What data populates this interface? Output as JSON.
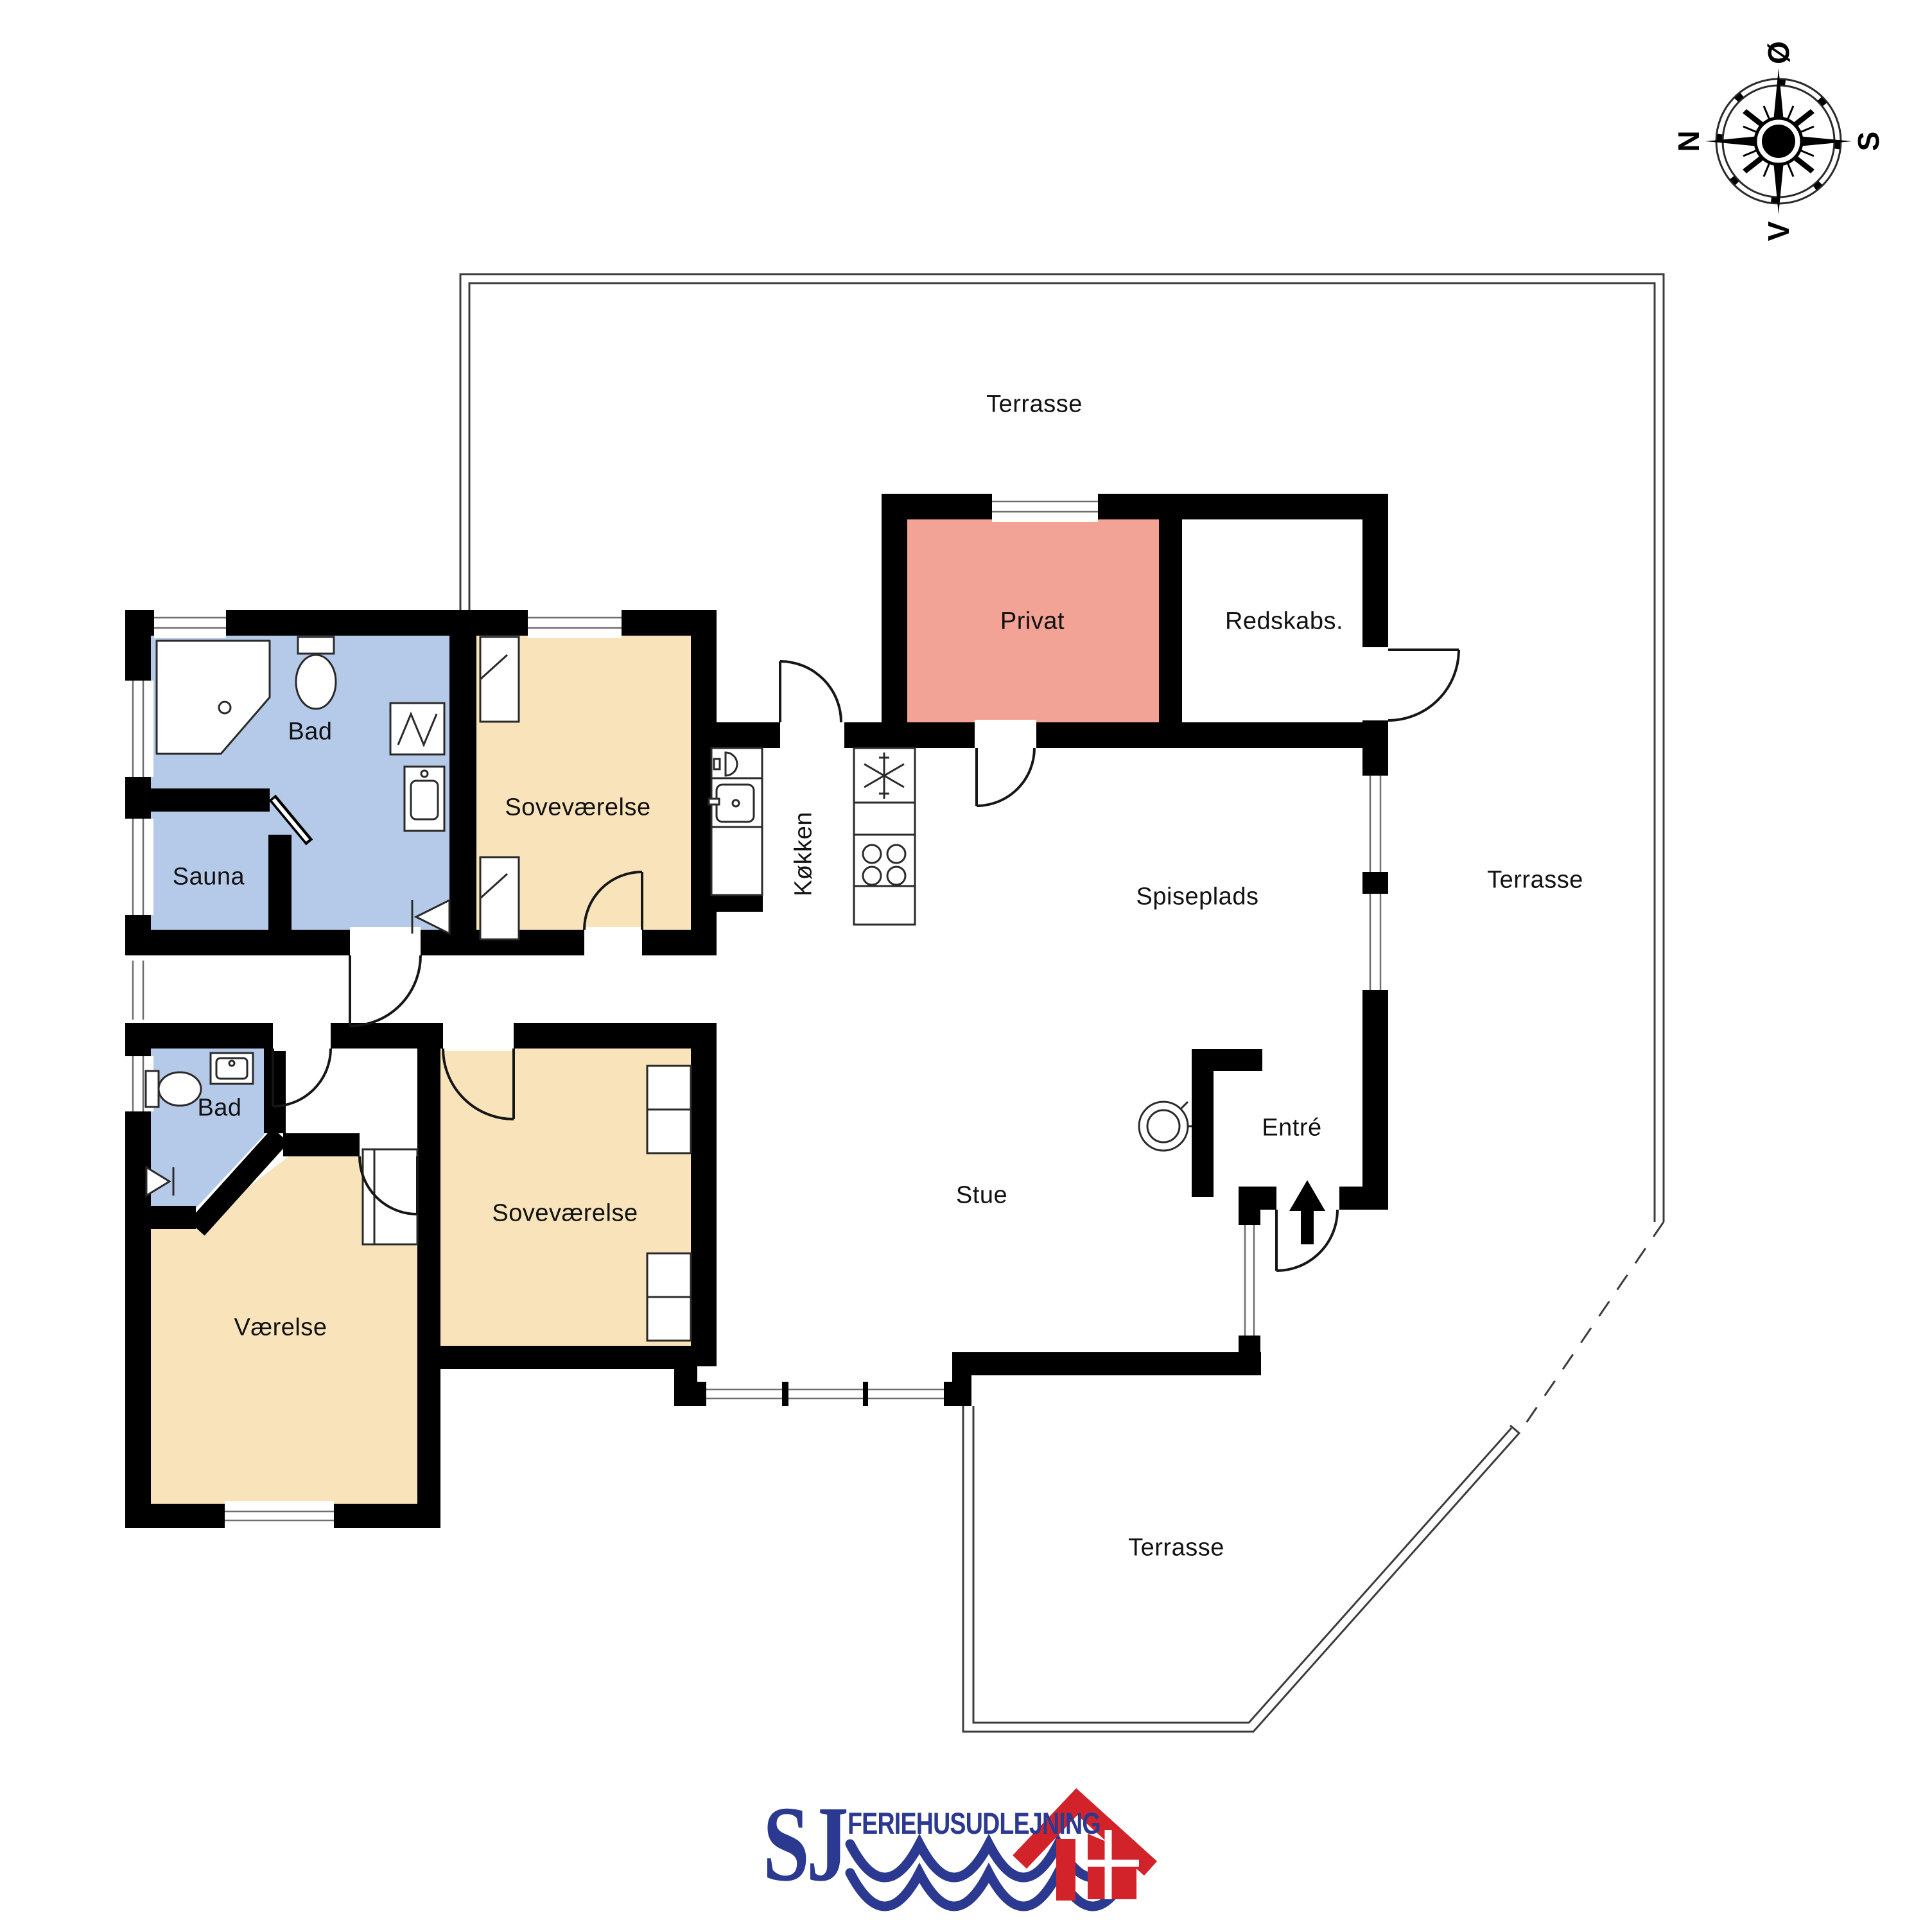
{
  "rooms": {
    "terrasse_top": {
      "label": "Terrasse"
    },
    "terrasse_right": {
      "label": "Terrasse"
    },
    "terrasse_bottom": {
      "label": "Terrasse"
    },
    "bad_top": {
      "label": "Bad"
    },
    "sauna": {
      "label": "Sauna"
    },
    "sovevaerelse_top": {
      "label": "Soveværelse"
    },
    "koekken": {
      "label": "Køkken"
    },
    "privat": {
      "label": "Privat"
    },
    "redskabs": {
      "label": "Redskabs."
    },
    "spiseplads": {
      "label": "Spiseplads"
    },
    "stue": {
      "label": "Stue"
    },
    "entre": {
      "label": "Entré"
    },
    "bad_lower": {
      "label": "Bad"
    },
    "vaerelse": {
      "label": "Værelse"
    },
    "sovevaerelse_lower": {
      "label": "Soveværelse"
    }
  },
  "compass": {
    "top": "Ø",
    "right": "S",
    "bottom": "V",
    "left": "N"
  },
  "logo": {
    "monogram": "SJ",
    "company": "FERIEHUSUDLEJNING"
  },
  "colors": {
    "wall": "#000000",
    "line": "#3c3c3c",
    "label": "#111111",
    "room_blue": "#b5c9e8",
    "room_beige": "#f8e3ba",
    "room_salmon": "#f3a296",
    "logo_blue": "#2b3990",
    "logo_red": "#d2232a"
  }
}
